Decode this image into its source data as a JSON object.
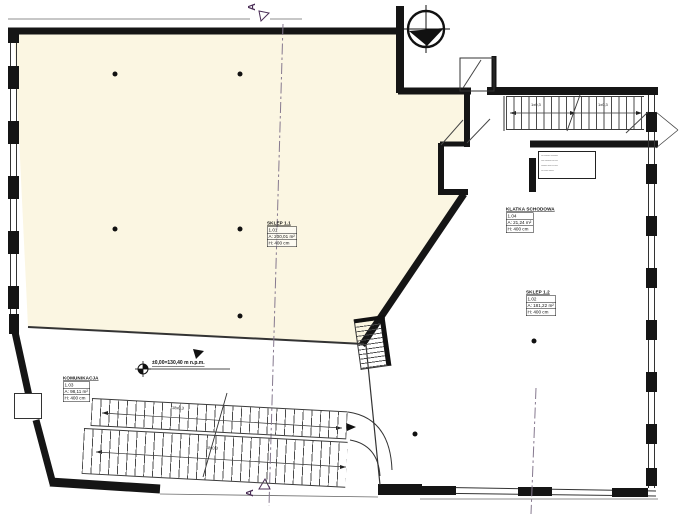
{
  "plan": {
    "rooms": {
      "sklep11": {
        "name": "SKLEP 1.1",
        "rows": [
          "1.01",
          "A: 200,01 m²",
          "H: 400 cm"
        ]
      },
      "sklep12": {
        "name": "SKLEP 1.2",
        "rows": [
          "1.02",
          "A: 181,22 m²",
          "H: 400 cm"
        ]
      },
      "klatka": {
        "name": "KLATKA SCHODOWA",
        "rows": [
          "1.04",
          "A: 21,24 m²",
          "H: 400 cm"
        ]
      },
      "komunikacja": {
        "name": "KOMUNIKACJA",
        "rows": [
          "1.03",
          "A: 98,11 m²",
          "H: 400 cm"
        ]
      }
    },
    "level_mark": "±0,00=130,40 m n.p.m.",
    "section_label_top": "A",
    "section_label_bottom": "A",
    "stair_dims": {
      "upper_left": "1x0,3",
      "upper_right": "1x0,3",
      "lower_first": "18x0,3",
      "lower_second": "18x0,3"
    },
    "note_lines": [
      "--- ------- ---------",
      "---- -------- --- ---",
      "------- ----- -- ----",
      "--- ----- ------"
    ],
    "colors": {
      "room_fill": "#fbf6e2",
      "wall": "#151515",
      "marker_accent": "#4a2d56",
      "section_line": "#86798f"
    }
  }
}
